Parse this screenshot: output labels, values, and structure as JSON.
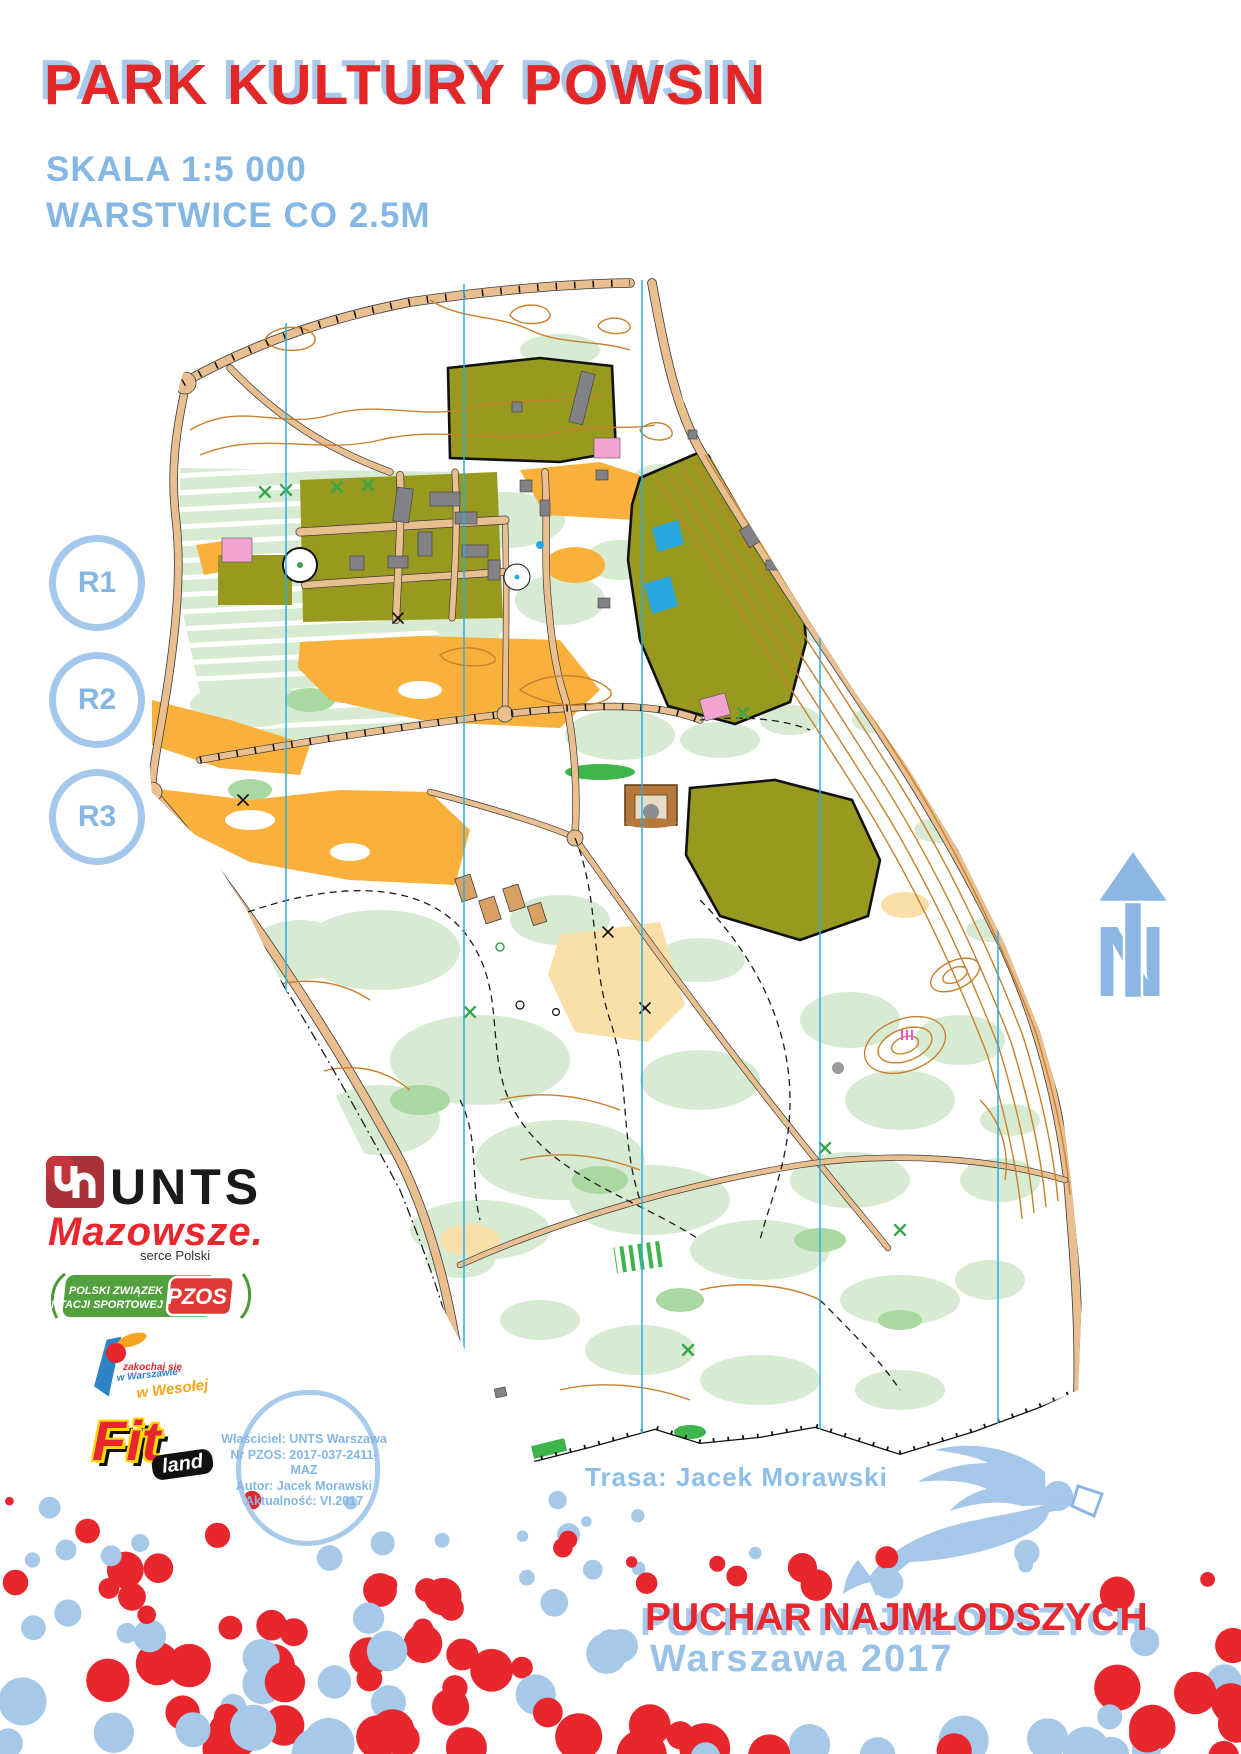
{
  "header": {
    "title": "PARK KULTURY POWSIN",
    "scale": "SKALA 1:5 000",
    "contours": "WARSTWICE CO 2.5M"
  },
  "route_markers": [
    {
      "label": "R1"
    },
    {
      "label": "R2"
    },
    {
      "label": "R3"
    }
  ],
  "map": {
    "north_label": "N",
    "course_credit": "Trasa: Jacek Morawski"
  },
  "credits_stamp": {
    "lines": [
      "Właściciel: UNTS Warszawa",
      "Nr PZOS: 2017-037-2411-MAZ",
      "Autor: Jacek Morawski",
      "Aktualność: VI.2017"
    ]
  },
  "sponsors": {
    "unts": {
      "name": "UNTS"
    },
    "mazowsze": {
      "name": "Mazowsze.",
      "tagline": "serce Polski"
    },
    "pzos": {
      "line1": "POLSKI ZWIĄZEK",
      "line2": "ORIENTACJI SPORTOWEJ",
      "badge": "PZOS"
    },
    "wesola": {
      "line1": "zakochaj się",
      "line2": "w Warszawie",
      "line3": "w Wesołej"
    },
    "fitland": {
      "main": "Fit",
      "sub": "land"
    }
  },
  "footer": {
    "event": "PUCHAR NAJMŁODSZYCH",
    "edition": "Warszawa 2017"
  },
  "colors": {
    "title_red": "#e32726",
    "accent_blue": "#85b7e4",
    "shadow_blue": "#a7c9ec",
    "confetti_red": "#e8262d",
    "confetti_blue": "#a6c9ea",
    "mermaid_blue": "#a4c7ea",
    "map_road": "#eabf90",
    "map_olive": "#98991f",
    "map_light_green": "#d6ebd1",
    "map_mid_green": "#a9d8a1",
    "map_dark_green": "#3db54a",
    "map_orange": "#f9b13c",
    "map_pale_orange": "#fbdfa8",
    "map_contour": "#c8802d",
    "map_blue": "#29a8e0",
    "map_gray": "#808285",
    "map_pink": "#f2a3d0"
  }
}
